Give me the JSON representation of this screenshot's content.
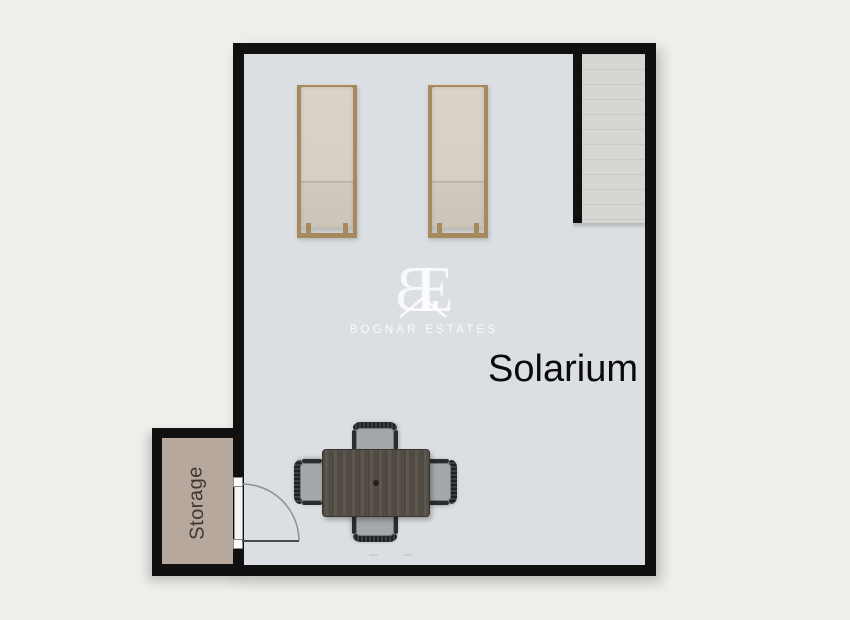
{
  "canvas": {
    "width": 850,
    "height": 620,
    "background_color": "#efeeea"
  },
  "plan": {
    "type": "floor-plan",
    "rooms": {
      "solarium": {
        "label": "Solarium",
        "floor_color": "#dbdee2",
        "label_color": "#0a0a0a"
      },
      "storage": {
        "label": "Storage",
        "floor_color": "#b6a89d",
        "label_color": "#3e3832"
      },
      "stair_niche": {
        "floor_color": "#d7d6d3"
      }
    },
    "wall_color": "#101010"
  },
  "watermark": {
    "monogram_b": "B",
    "monogram_e": "E",
    "brand": "BOGNAR ESTATES",
    "color": "#ffffff"
  },
  "furniture": {
    "sun_loungers": {
      "count": 2,
      "frame_color": "#a6895c",
      "cushion_color": "#d6cfc4"
    },
    "dining_table": {
      "top_color": "#58514a"
    },
    "dining_chairs": {
      "count": 4,
      "seat_color": "#a4a8ab",
      "frame_color": "#25282a"
    },
    "door": {
      "type": "hinged-single",
      "swing": "opens-into-solarium"
    }
  }
}
